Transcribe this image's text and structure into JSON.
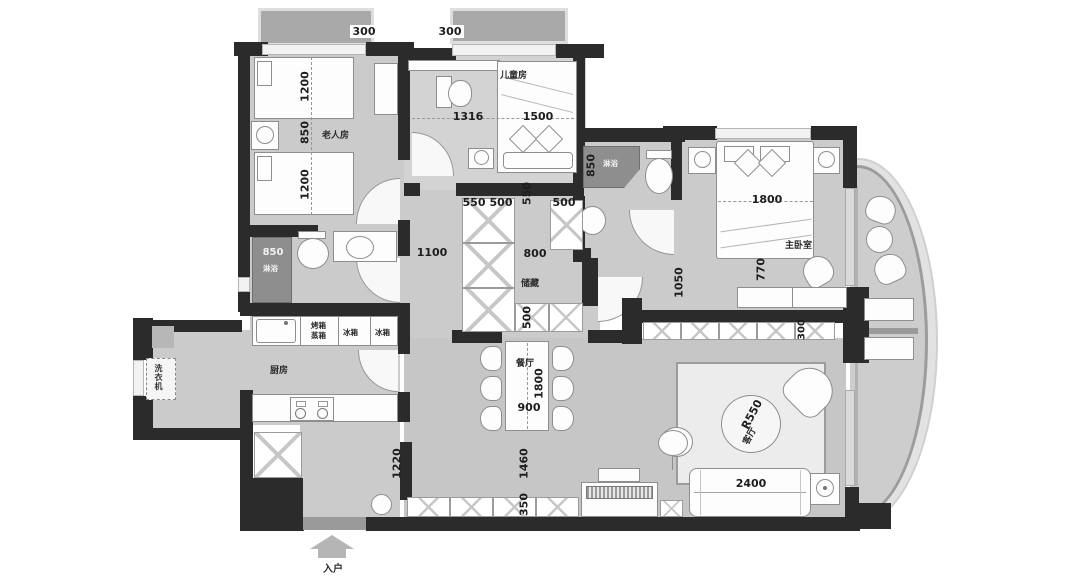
{
  "plan": {
    "bays": {
      "left": "300",
      "right": "300"
    },
    "elder": {
      "name": "老人房",
      "bed_top": "1200",
      "middle": "850",
      "bed_bottom": "1200"
    },
    "kids": {
      "name": "儿童房",
      "desk": "1316",
      "bed": "1500"
    },
    "bath_top": {
      "size": "850",
      "label": "淋浴"
    },
    "bath_left": {
      "size": "850",
      "label": "淋浴"
    },
    "master": {
      "name": "主卧室",
      "bed": "1800",
      "clearance": "770",
      "hall": "1050",
      "cabinet": "300"
    },
    "storage": {
      "name": "储藏",
      "a": "550",
      "b": "500",
      "side": "550",
      "c": "500",
      "walk": "800",
      "bottom": "500",
      "hall": "1100"
    },
    "kitchen": {
      "name": "厨房",
      "oven1": "烤箱",
      "oven2": "蒸箱",
      "fridge1": "冰箱",
      "fridge2": "冰箱"
    },
    "laundry": {
      "washer": "洗衣机"
    },
    "dining": {
      "name": "餐厅",
      "length": "1800",
      "width": "900"
    },
    "living": {
      "name": "客厅",
      "radius": "R550",
      "sofa": "2400"
    },
    "halls": {
      "kitchen": "1220",
      "living": "1460",
      "shoe": "350"
    },
    "entrance": {
      "label": "入户"
    }
  }
}
